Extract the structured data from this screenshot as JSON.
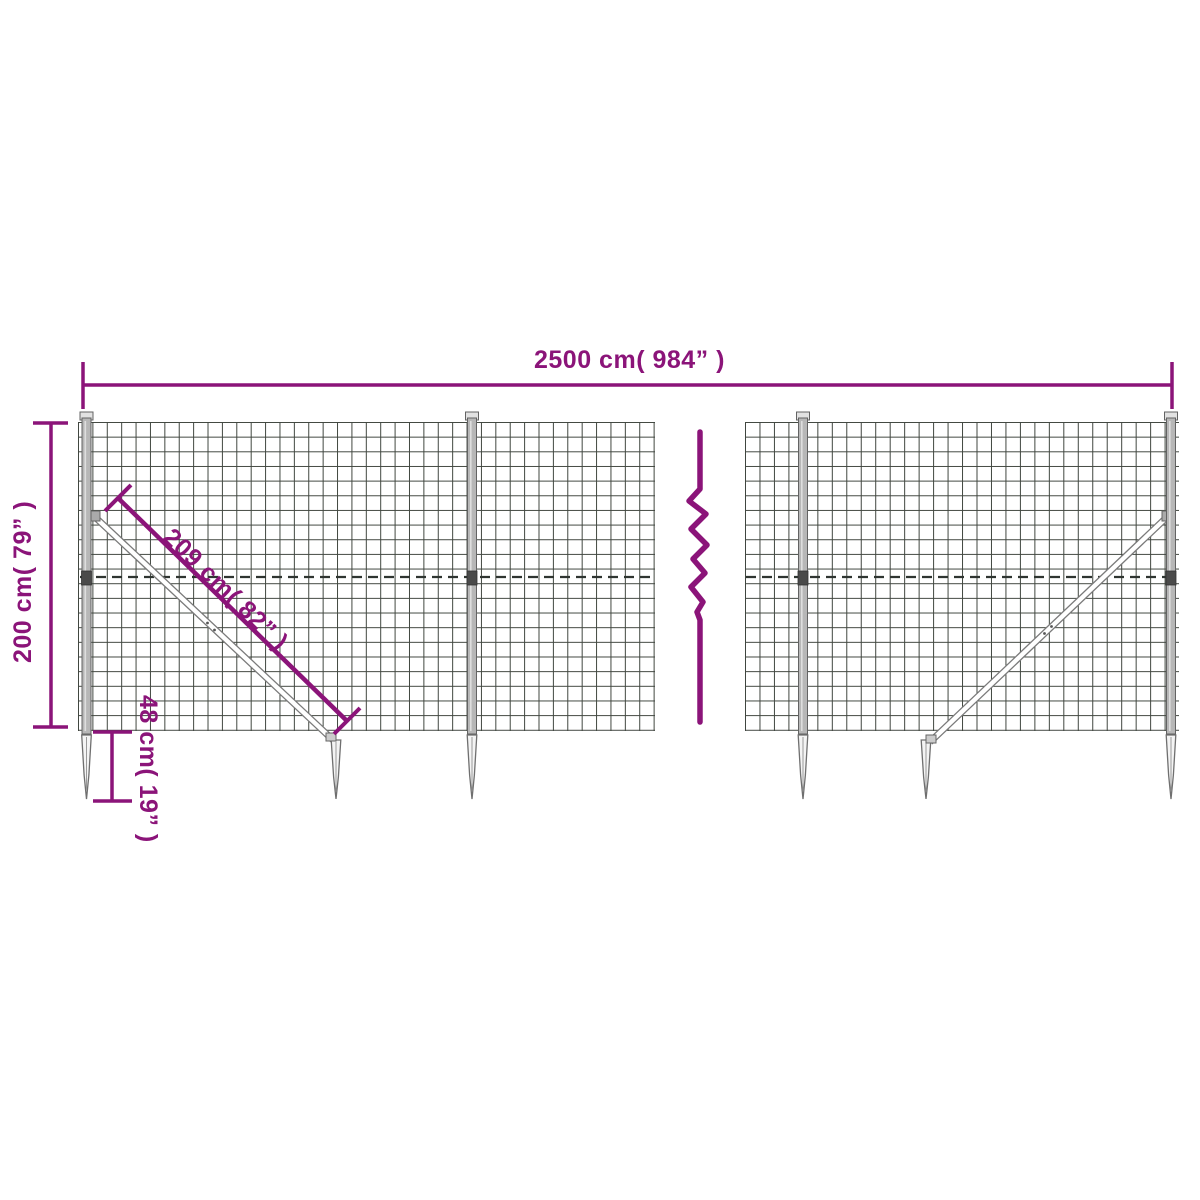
{
  "diagram": {
    "dimensions": {
      "width": {
        "label": "2500 cm( 984” )"
      },
      "height": {
        "label": "200 cm( 79” )"
      },
      "brace": {
        "label": "209 cm( 82” )"
      },
      "anchor": {
        "label": "48 cm( 19” )"
      }
    },
    "colors": {
      "accent": "#8b1479",
      "mesh_line": "#40463f",
      "metal_outline": "#6f6f6f",
      "metal_fill": "#f4f4f4",
      "post_fill": "#b7b7b7",
      "background": "#ffffff"
    }
  }
}
